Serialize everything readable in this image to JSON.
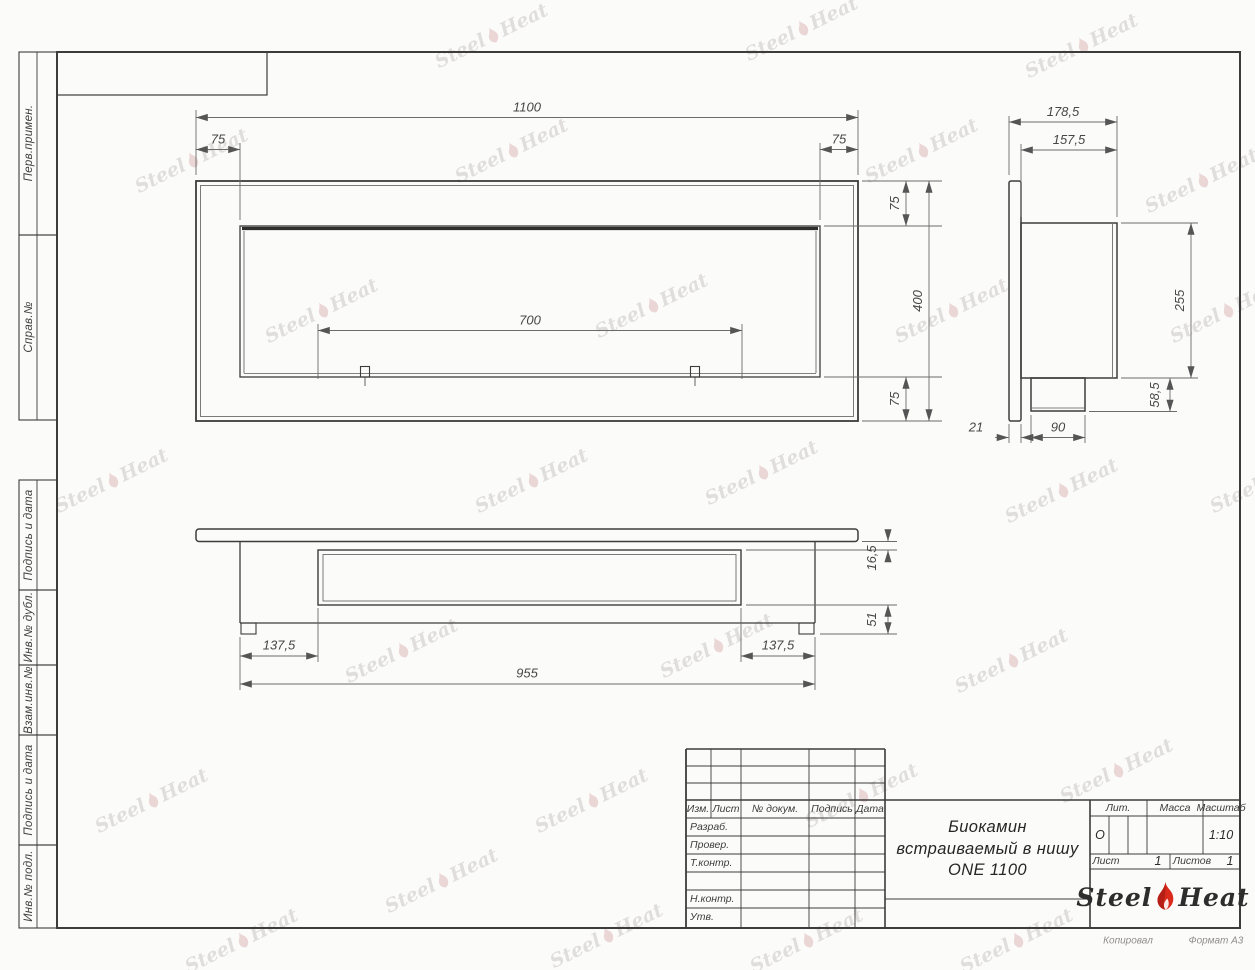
{
  "sheet": {
    "margin_labels": [
      "Перв.примен.",
      "Справ.№",
      "Подпись и дата",
      "Инв.№ дубл.",
      "Взам.инв.№",
      "Подпись и дата",
      "Инв.№ подл."
    ]
  },
  "views": {
    "front": {
      "dims": {
        "width_total": "1100",
        "offset_left": "75",
        "offset_right": "75",
        "burner_width": "700",
        "offset_top": "75",
        "height_total": "400",
        "offset_bottom": "75"
      }
    },
    "side": {
      "dims": {
        "depth_total": "178,5",
        "depth_body": "157,5",
        "height_body": "255",
        "height_block": "58,5",
        "flange_thickness": "21",
        "block_width": "90"
      }
    },
    "bottom": {
      "dims": {
        "inset": "16,5",
        "base_height": "51",
        "offset_left": "137,5",
        "body_length": "955",
        "offset_right": "137,5"
      }
    }
  },
  "title_block": {
    "revision_header": [
      "Изм.",
      "Лист",
      "№ докум.",
      "Подпись",
      "Дата"
    ],
    "rows": [
      "Разраб.",
      "Провер.",
      "Т.контр.",
      "",
      "Н.контр.",
      "Утв."
    ],
    "title": "Биокамин\nвстраиваемый в нишу\nONE 1100",
    "lit_label": "Лит.",
    "lit_value": "О",
    "mass_label": "Масса",
    "scale_label": "Масштаб",
    "scale_value": "1:10",
    "sheet_label": "Лист",
    "sheet_value": "1",
    "sheets_label": "Листов",
    "sheets_value": "1",
    "logo": {
      "part1": "Steel",
      "part2": "Heat"
    },
    "footer": {
      "copied": "Копировал",
      "format": "Формат А3"
    }
  },
  "watermark": {
    "part1": "Steel",
    "part2": "Heat"
  },
  "colors": {
    "line": "#3c3c3c",
    "dim_line": "#6b6b6b",
    "flame_red": "#d92a1c"
  }
}
